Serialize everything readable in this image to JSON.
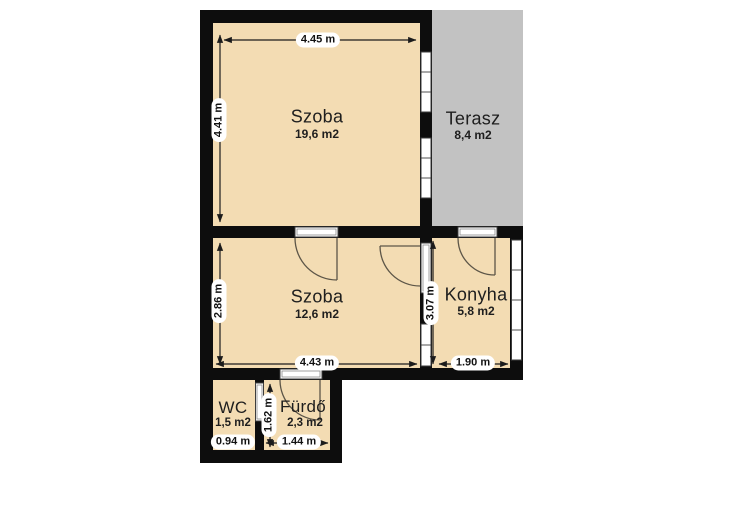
{
  "floorplan": {
    "rooms": [
      {
        "id": "szoba-top",
        "name": "Szoba",
        "area": "19,6 m2"
      },
      {
        "id": "terasz",
        "name": "Terasz",
        "area": "8,4 m2"
      },
      {
        "id": "szoba-mid",
        "name": "Szoba",
        "area": "12,6 m2"
      },
      {
        "id": "konyha",
        "name": "Konyha",
        "area": "5,8 m2"
      },
      {
        "id": "wc",
        "name": "WC",
        "area": "1,5 m2"
      },
      {
        "id": "furdo",
        "name": "Fürdő",
        "area": "2,3 m2"
      }
    ],
    "dimensions": {
      "top_width": "4.45 m",
      "top_height": "4.41 m",
      "mid_height": "2.86 m",
      "mid_width": "4.43 m",
      "konyha_height": "3.07 m",
      "konyha_width": "1.90 m",
      "wc_width": "0.94 m",
      "furdo_height": "1.62 m",
      "furdo_width": "1.44 m"
    },
    "colors": {
      "room_fill": "#f3dcb3",
      "terrace_fill": "#c2c2c2",
      "wall_color": "#0d0d0d",
      "background": "#ffffff"
    }
  }
}
